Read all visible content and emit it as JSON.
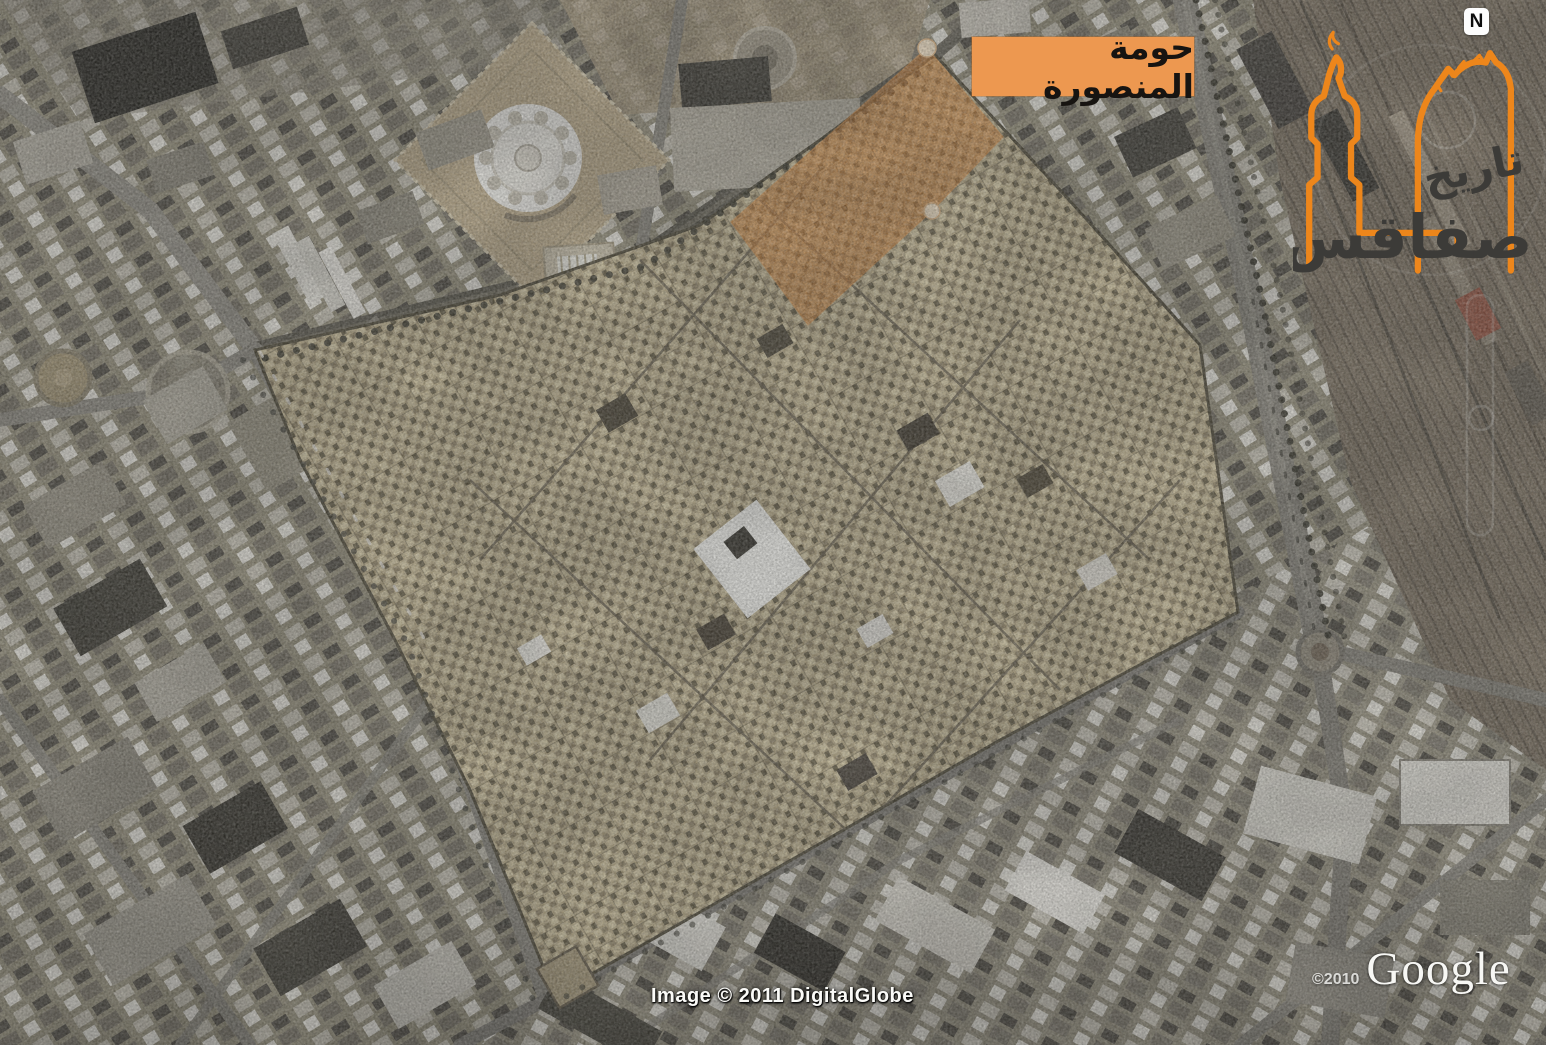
{
  "scene": {
    "region_label": "حومة المنصورة",
    "compass_label": "N",
    "highlight": {
      "name": "houmat-el-mansoura-district",
      "polygon_points": "927,48 1003,137 932,211 808,325 731,222",
      "fill_color": "#dd8a3e"
    }
  },
  "logo": {
    "text_top": "تاريخ",
    "text_bottom": "صفاقس",
    "accent_color": "#ED861B"
  },
  "watermarks": {
    "copyright_year": "©2010",
    "brand": "Google",
    "attribution": "Image © 2011 DigitalGlobe"
  },
  "colors": {
    "label_background": "#ED9850",
    "label_text": "#171411",
    "medina_base": "#bdb08e",
    "city_base": "#98937f"
  }
}
